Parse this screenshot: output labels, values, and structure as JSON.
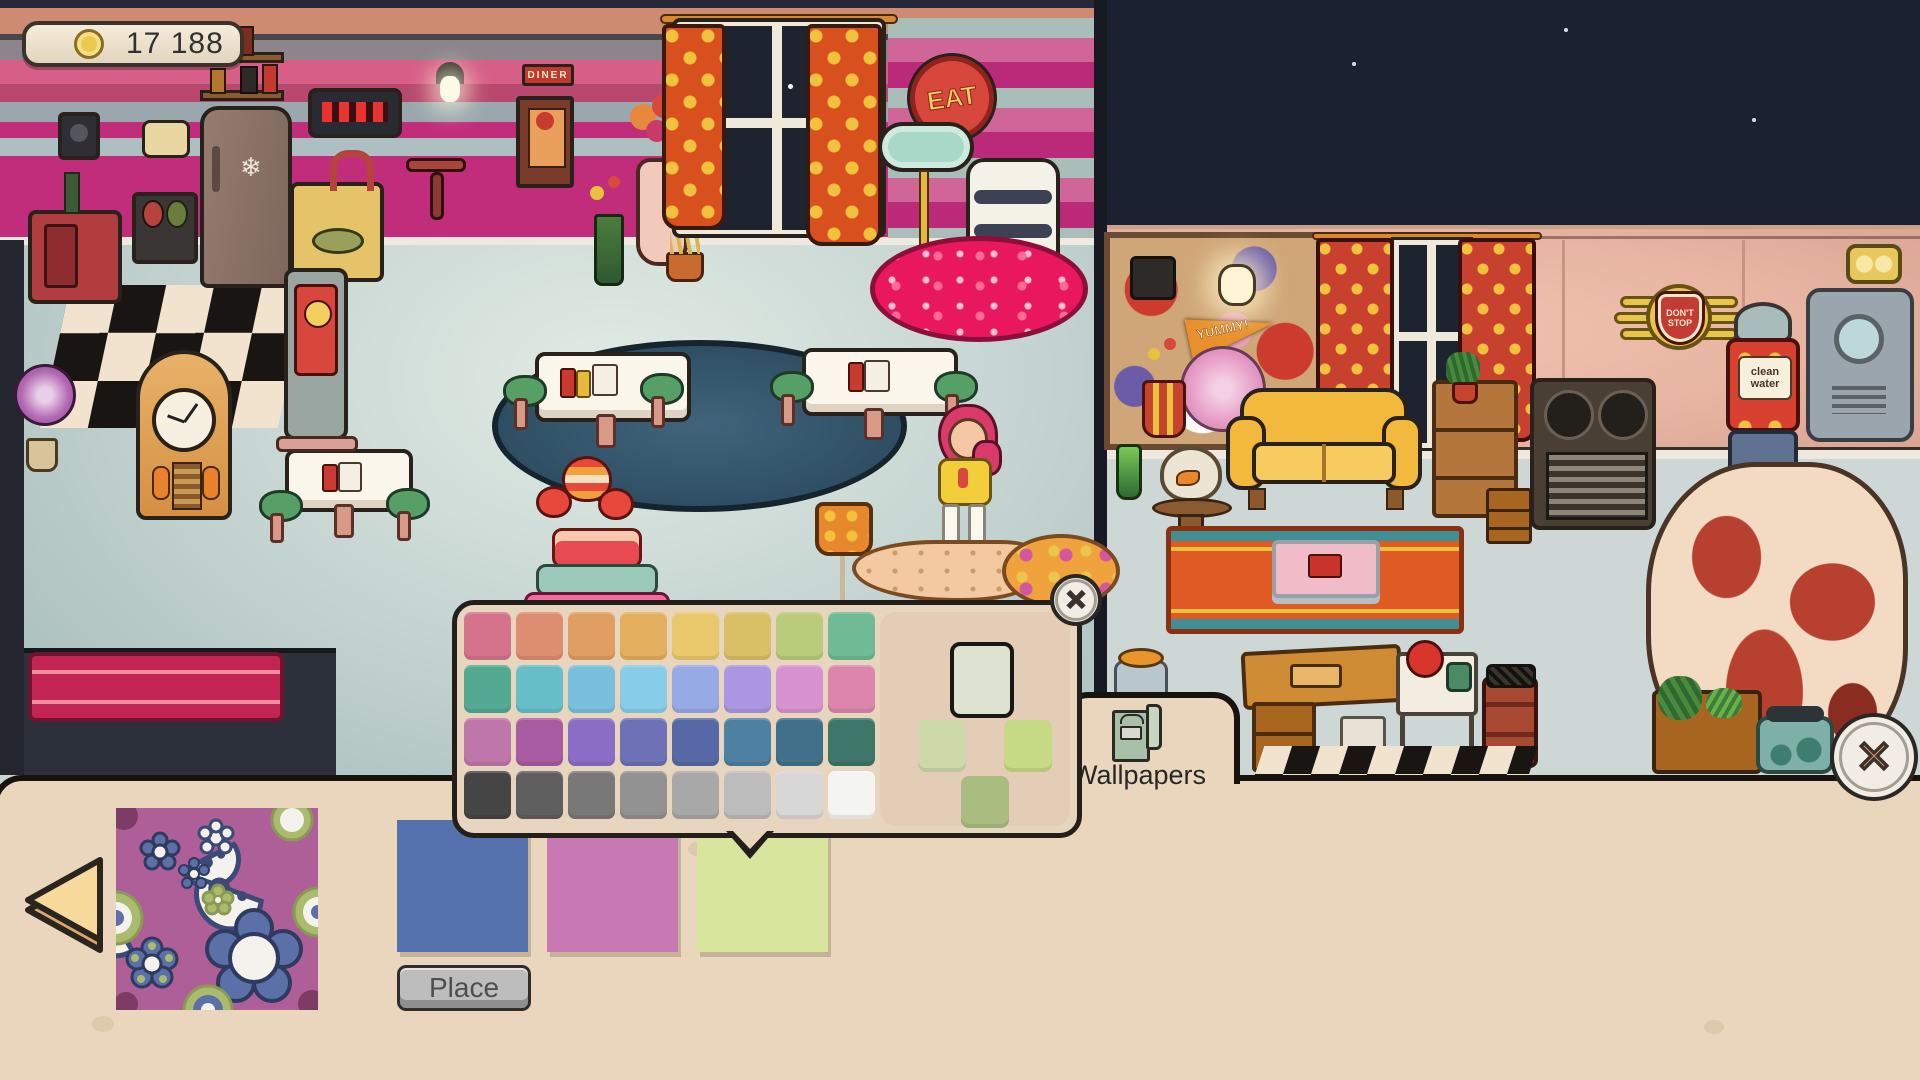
{
  "hud": {
    "coins": "17 188",
    "coin_icon": "coin-icon"
  },
  "scene": {
    "signs": {
      "eat": "EAT",
      "diner": "DINER",
      "yummy": "YUMMY!",
      "dont_stop": "DON'T STOP",
      "clean_water": "clean water"
    }
  },
  "color_picker": {
    "palette_rows": [
      [
        "#d4738b",
        "#dd8d70",
        "#e09e62",
        "#e3af5e",
        "#e9c96b",
        "#d9bf66",
        "#b8cc7c",
        "#70ba95"
      ],
      [
        "#54a992",
        "#66bec9",
        "#78c0dd",
        "#87cce8",
        "#96aae5",
        "#aa96e1",
        "#d892d1",
        "#dc86ae"
      ],
      [
        "#bf76a8",
        "#a95ba1",
        "#8b6dc5",
        "#6c72b5",
        "#5668a5",
        "#4d80a1",
        "#40708a",
        "#3e7669"
      ],
      [
        "#454545",
        "#5f5f5f",
        "#787878",
        "#929292",
        "#a8a8a8",
        "#bcbcbc",
        "#d7d7d7",
        "#f4f4f0"
      ]
    ],
    "selection": {
      "current": "#dee3d1",
      "left": "#cdd9a9",
      "right": "#c6d985",
      "bottom": "#a9bd81"
    },
    "close_icon": "close-icon"
  },
  "tab": {
    "label": "Wallpapers",
    "icon": "wallpaper-roll-icon"
  },
  "bottom_panel": {
    "swatches": [
      {
        "id": "blue",
        "color": "#5571ad",
        "selected": false
      },
      {
        "id": "pink",
        "color": "#c879b3",
        "selected": false
      },
      {
        "id": "green",
        "color": "#d7e59d",
        "selected": true
      }
    ],
    "place_label": "Place",
    "preview": {
      "type": "paisley-floral",
      "colors": {
        "bg": "#ae5f98",
        "navy": "#3c4a78",
        "white": "#f5f2ee",
        "green": "#a9bc6e",
        "olive": "#8a9a55",
        "plum": "#7c3c66"
      }
    }
  },
  "theme": {
    "panel": "#e9d6bd",
    "outline": "#18130f",
    "x_accent": "#e8996c"
  }
}
